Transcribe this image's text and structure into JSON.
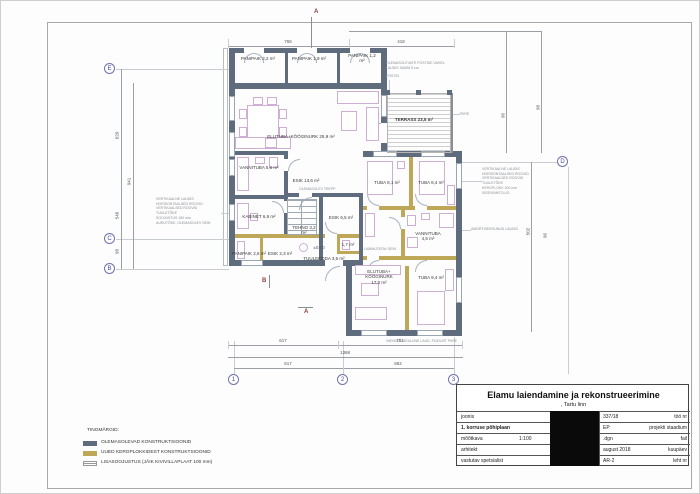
{
  "drawing": {
    "rooms": [
      "PANIPAIK 2,2 m²",
      "PANIPAIK 1,9 m²",
      "PANIPAIK 1,2 m²",
      "ELUTUBA+KÖÖGINURK 25,9 m²",
      "VANNITUBA 5,6 m²",
      "ESIK 13,6 m²",
      "KABINET 6,9 m²",
      "ESIK 6,5 m²",
      "TEHNO 3,2 m²",
      "PANIPAIK 2,6 m²",
      "ESIK 2,3 m²",
      "TUULEKODA 3,6 m²",
      "1,7 m²",
      "TUBA 8,1 m²",
      "TUBA 8,4 m²",
      "VANNITUBA 4,5 m²",
      "ELUTUBA+ KÖÖGINURK 17,0 m²",
      "TUBA 9,4 m²",
      "TERRASS 23,5 m²"
    ],
    "grid": [
      "E",
      "C",
      "B",
      "D",
      "1",
      "2",
      "3"
    ],
    "section": {
      "top": "A",
      "bottom": "A",
      "mid": "B"
    },
    "level": "±0.00",
    "dims": {
      "top": [
        "765",
        "418"
      ],
      "bottom": [
        "617",
        "751",
        "1368",
        "617",
        "862"
      ],
      "left": [
        "620",
        "941",
        "546",
        "98"
      ],
      "right": [
        "96",
        "98",
        "502",
        "96"
      ]
    },
    "annotations": {
      "left_wall": [
        "VERTIKAALNE LAUDIS",
        "HORISONTAALSED ROOVID",
        "VERTIKAALSED ROOVID",
        "TUULETÕKE",
        "SOOJUSTUS 150 mm",
        "AURUTÕKE, OLEMASOLEV SEIN"
      ],
      "right_wall": [
        "VERTIKAALNE LAUDIS",
        "HORISONTAALSED ROOVID",
        "VERTIKAALSED ROOVID",
        "TUULETÕKE",
        "KERGPLOKK 200 mm",
        "SISEVIIMISTLUS"
      ],
      "right_wall2": "AMORTISEERUNUD LAUDIS",
      "terrace_1": "OLEMASOLEVATE POSTIDE VAHEL",
      "terrace_2": "LAUDIS SAMM 5 cm",
      "terrace_3": "POSTID",
      "railing": "PIIRE",
      "demolish": "LAMMUTATAV SEIN",
      "canopy": "VARIKATUSEALUNE LAUD, PUIDUST PIIRE",
      "stairs": "OLEMASOLEV TREPP"
    }
  },
  "legend": {
    "title": "TINGMÄRGID:",
    "items": [
      {
        "label": "OLEMASOLEVAD KONSTRUKTSIOONID"
      },
      {
        "label": "UUED KERGPLOKKIDEST KONSTRUKTSIOONID"
      },
      {
        "label": "LISASOOJUSTUS (JÄIK KIVIVILLAPLAAT 100 mm)"
      }
    ]
  },
  "titleblock": {
    "title": "Elamu laiendamine ja  rekonstrueerimine",
    "subtitle": ", Tartu linn",
    "rows": [
      {
        "label": "joonis",
        "value": "337/18",
        "unit": "töö nr"
      },
      {
        "label": "1. korruse põhiplaan",
        "value": "EP",
        "unit": "projekti staadium"
      },
      {
        "label": "mõõtkava",
        "mid": "1:100",
        "value": ".dgn",
        "unit": "fail"
      },
      {
        "label": "arhitekt",
        "value": "august 2018",
        "unit": "kuupäev"
      },
      {
        "label": "vastutav spetsialist",
        "value": "AR-2",
        "unit": "leht nr"
      }
    ]
  },
  "colors": {
    "existing": "#5e6c7d",
    "new": "#bfa758",
    "furniture": "#cfaed3"
  }
}
